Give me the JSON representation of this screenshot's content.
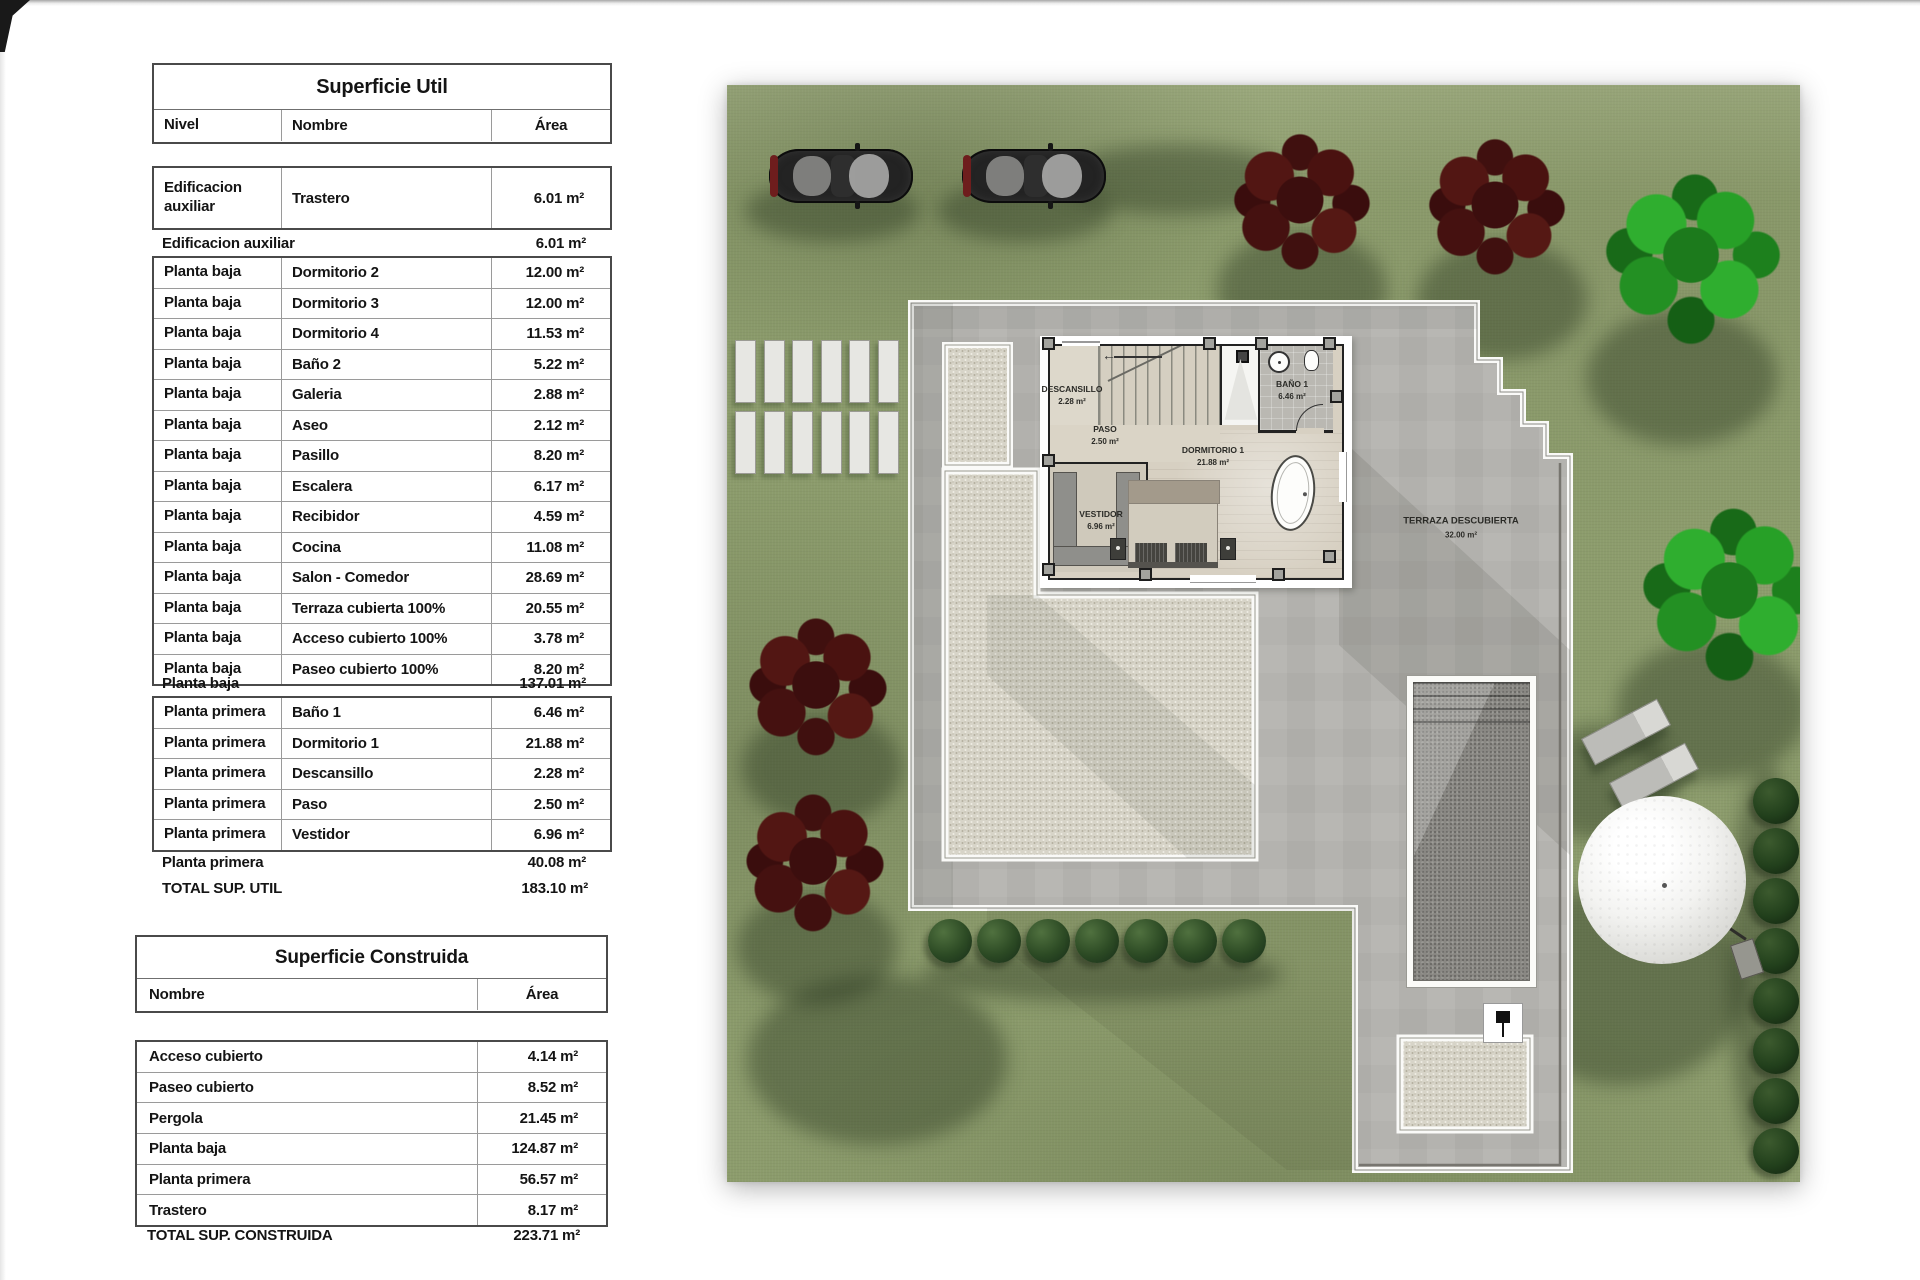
{
  "tables": {
    "util": {
      "title": "Superficie Util",
      "col_nivel": "Nivel",
      "col_nombre": "Nombre",
      "col_area": "Área",
      "aux_rows": [
        {
          "nivel": "Edificacion auxiliar",
          "nombre": "Trastero",
          "area": "6.01 m²"
        }
      ],
      "aux_total_label": "Edificacion auxiliar",
      "aux_total_area": "6.01 m²",
      "pb_rows": [
        {
          "nivel": "Planta baja",
          "nombre": "Dormitorio 2",
          "area": "12.00 m²"
        },
        {
          "nivel": "Planta baja",
          "nombre": "Dormitorio 3",
          "area": "12.00 m²"
        },
        {
          "nivel": "Planta baja",
          "nombre": "Dormitorio 4",
          "area": "11.53 m²"
        },
        {
          "nivel": "Planta baja",
          "nombre": "Baño 2",
          "area": "5.22 m²"
        },
        {
          "nivel": "Planta baja",
          "nombre": "Galeria",
          "area": "2.88 m²"
        },
        {
          "nivel": "Planta baja",
          "nombre": "Aseo",
          "area": "2.12 m²"
        },
        {
          "nivel": "Planta baja",
          "nombre": "Pasillo",
          "area": "8.20 m²"
        },
        {
          "nivel": "Planta baja",
          "nombre": "Escalera",
          "area": "6.17 m²"
        },
        {
          "nivel": "Planta baja",
          "nombre": "Recibidor",
          "area": "4.59 m²"
        },
        {
          "nivel": "Planta baja",
          "nombre": "Cocina",
          "area": "11.08 m²"
        },
        {
          "nivel": "Planta baja",
          "nombre": "Salon - Comedor",
          "area": "28.69 m²"
        },
        {
          "nivel": "Planta baja",
          "nombre": "Terraza cubierta 100%",
          "area": "20.55 m²"
        },
        {
          "nivel": "Planta baja",
          "nombre": "Acceso cubierto 100%",
          "area": "3.78 m²"
        },
        {
          "nivel": "Planta baja",
          "nombre": "Paseo cubierto 100%",
          "area": "8.20 m²"
        }
      ],
      "pb_total_label": "Planta baja",
      "pb_total_area": "137.01 m²",
      "pp_rows": [
        {
          "nivel": "Planta primera",
          "nombre": "Baño 1",
          "area": "6.46 m²"
        },
        {
          "nivel": "Planta primera",
          "nombre": "Dormitorio 1",
          "area": "21.88 m²"
        },
        {
          "nivel": "Planta primera",
          "nombre": "Descansillo",
          "area": "2.28 m²"
        },
        {
          "nivel": "Planta primera",
          "nombre": "Paso",
          "area": "2.50 m²"
        },
        {
          "nivel": "Planta primera",
          "nombre": "Vestidor",
          "area": "6.96 m²"
        }
      ],
      "pp_total_label": "Planta primera",
      "pp_total_area": "40.08 m²",
      "grand_total_label": "TOTAL SUP. UTIL",
      "grand_total_area": "183.10 m²"
    },
    "construida": {
      "title": "Superficie Construida",
      "col_nombre": "Nombre",
      "col_area": "Área",
      "rows": [
        {
          "nombre": "Acceso cubierto",
          "area": "4.14 m²"
        },
        {
          "nombre": "Paseo cubierto",
          "area": "8.52 m²"
        },
        {
          "nombre": "Pergola",
          "area": "21.45 m²"
        },
        {
          "nombre": "Planta baja",
          "area": "124.87 m²"
        },
        {
          "nombre": "Planta primera",
          "area": "56.57 m²"
        },
        {
          "nombre": "Trastero",
          "area": "8.17 m²"
        }
      ],
      "total_label": "TOTAL SUP. CONSTRUIDA",
      "total_area": "223.71 m²"
    }
  },
  "plan": {
    "rooms": [
      {
        "name": "DESCANSILLO",
        "area": "2.28 m²"
      },
      {
        "name": "PASO",
        "area": "2.50 m²"
      },
      {
        "name": "BAÑO 1",
        "area": "6.46 m²"
      },
      {
        "name": "DORMITORIO 1",
        "area": "21.88 m²"
      },
      {
        "name": "VESTIDOR",
        "area": "6.96 m²"
      },
      {
        "name": "TERRAZA DESCUBIERTA",
        "area": "32.00 m²"
      }
    ],
    "stair_arrow": "←"
  },
  "colors": {
    "lawn": "#8c9c6c",
    "plot": "#b4b3af",
    "gravel": "#d7d4c8",
    "wall": "#232323",
    "pool": "#8a8984",
    "bush": "#2c4a24",
    "tree_red": "#4a1212",
    "tree_green": "#27a027"
  }
}
